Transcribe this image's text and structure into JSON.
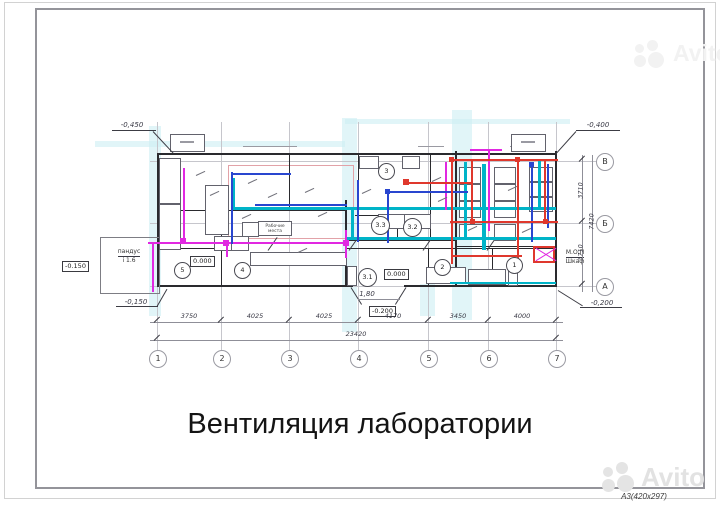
{
  "page": {
    "title": "Вентиляция лаборатории",
    "format_label": "A3(420x297)"
  },
  "watermark": {
    "brand": "Avito"
  },
  "axes": {
    "columns": [
      "1",
      "2",
      "3",
      "4",
      "5",
      "6",
      "7"
    ],
    "rows": [
      "В",
      "Б",
      "А"
    ]
  },
  "dimensions": {
    "bottom_segments": [
      "3750",
      "4025",
      "4025",
      "4170",
      "3450",
      "4000"
    ],
    "bottom_total": "23420",
    "right_segments": [
      "3710",
      "3710"
    ],
    "right_total": "7420",
    "entry_width": "1,80"
  },
  "elevations": {
    "top_left": "-0,450",
    "top_right": "-0,400",
    "bottom_left": "-0,150",
    "bottom_right": "-0,200",
    "boxed_ramp": "-0.150",
    "boxed_entry": "-0.200",
    "level_hall": "0.000",
    "level_lobby": "0.000"
  },
  "labels": {
    "ramp_line1": "пандус",
    "ramp_line2": "i 1.6",
    "mop_line1": "М.О.П",
    "mop_line2": "Шкаф",
    "workplaces_line1": "Рабочие",
    "workplaces_line2": "места"
  },
  "rooms": {
    "r1": "1",
    "r2": "2",
    "r3": "3",
    "r31": "3.1",
    "r32": "3.2",
    "r33": "3.3",
    "r4": "4",
    "r5": "5"
  },
  "colors": {
    "duct_supply_cyan": "#00b4c8",
    "duct_exhaust_magenta": "#e128e1",
    "duct_blue": "#2946cf",
    "duct_red": "#df382d",
    "grid_highlight": "#cdeff3"
  }
}
